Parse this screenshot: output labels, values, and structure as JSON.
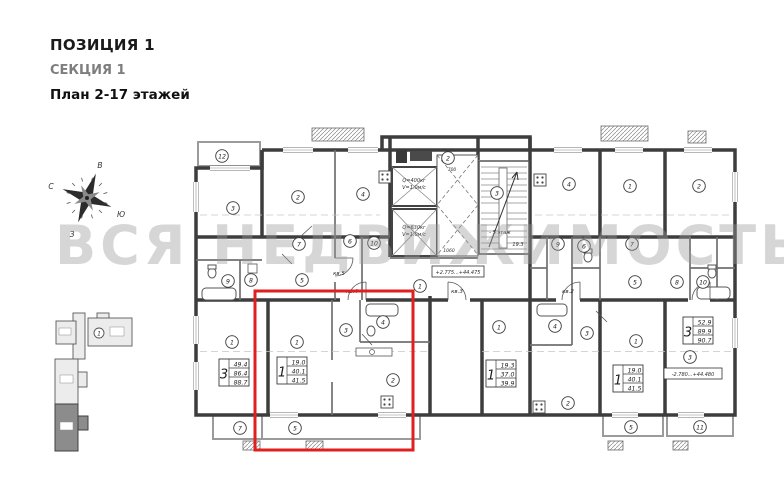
{
  "header": {
    "position": "ПОЗИЦИЯ 1",
    "section": "СЕКЦИЯ 1",
    "plan": "План 2-17 этажей"
  },
  "watermark": "ВСЯ НЕДВИЖИМОСТЬ",
  "compass": {
    "north": "С",
    "east": "В",
    "south": "Ю",
    "west": "З"
  },
  "minimap": {
    "position_label": "1"
  },
  "highlight": {
    "color": "#e01f1f"
  },
  "plan": {
    "elevators": [
      {
        "line1": "Q=400кг",
        "line2": "V=1.0м/с"
      },
      {
        "line1": "Q=630кг",
        "line2": "V=1.0м/с"
      }
    ],
    "stairs_note": "- 5 этаж",
    "stairs_area": "19.3",
    "dim_700": "700",
    "dim_1060": "1060",
    "elevation_core": "+2.775...+44.475",
    "elevation_right": "-2.780...+44.480",
    "apartment_labels": [
      {
        "label": "кв.5",
        "x": 339,
        "y": 275
      },
      {
        "label": "кв.4",
        "x": 352,
        "y": 293
      },
      {
        "label": "кв.3",
        "x": 457,
        "y": 293
      },
      {
        "label": "кв.2",
        "x": 568,
        "y": 293
      }
    ],
    "spec_tables": [
      {
        "rooms": "3",
        "values": [
          "49.4",
          "86.4",
          "88.7"
        ],
        "x": 219,
        "y": 359
      },
      {
        "rooms": "1",
        "values": [
          "19.0",
          "40.1",
          "41.5"
        ],
        "x": 277,
        "y": 357
      },
      {
        "rooms": "1",
        "values": [
          "19.3",
          "37.0",
          "39.9"
        ],
        "x": 486,
        "y": 360
      },
      {
        "rooms": "1",
        "values": [
          "19.0",
          "40.1",
          "41.5"
        ],
        "x": 613,
        "y": 365
      },
      {
        "rooms": "3",
        "values": [
          "52.9",
          "89.9",
          "90.7"
        ],
        "x": 683,
        "y": 317
      }
    ],
    "room_circles": [
      {
        "n": "12",
        "x": 222,
        "y": 156
      },
      {
        "n": "3",
        "x": 233,
        "y": 208
      },
      {
        "n": "2",
        "x": 298,
        "y": 197
      },
      {
        "n": "4",
        "x": 363,
        "y": 194
      },
      {
        "n": "2",
        "x": 448,
        "y": 158
      },
      {
        "n": "3",
        "x": 497,
        "y": 193
      },
      {
        "n": "4",
        "x": 569,
        "y": 184
      },
      {
        "n": "1",
        "x": 630,
        "y": 186
      },
      {
        "n": "2",
        "x": 699,
        "y": 186
      },
      {
        "n": "7",
        "x": 299,
        "y": 244
      },
      {
        "n": "6",
        "x": 350,
        "y": 241
      },
      {
        "n": "10",
        "x": 374,
        "y": 243
      },
      {
        "n": "9",
        "x": 558,
        "y": 244
      },
      {
        "n": "6",
        "x": 584,
        "y": 246
      },
      {
        "n": "7",
        "x": 632,
        "y": 244
      },
      {
        "n": "9",
        "x": 228,
        "y": 281
      },
      {
        "n": "8",
        "x": 251,
        "y": 280
      },
      {
        "n": "5",
        "x": 302,
        "y": 280
      },
      {
        "n": "1",
        "x": 420,
        "y": 286
      },
      {
        "n": "5",
        "x": 635,
        "y": 282
      },
      {
        "n": "8",
        "x": 677,
        "y": 282
      },
      {
        "n": "10",
        "x": 703,
        "y": 282
      },
      {
        "n": "1",
        "x": 232,
        "y": 342
      },
      {
        "n": "1",
        "x": 297,
        "y": 342
      },
      {
        "n": "3",
        "x": 346,
        "y": 330
      },
      {
        "n": "4",
        "x": 383,
        "y": 322
      },
      {
        "n": "2",
        "x": 393,
        "y": 380
      },
      {
        "n": "1",
        "x": 499,
        "y": 327
      },
      {
        "n": "4",
        "x": 555,
        "y": 326
      },
      {
        "n": "3",
        "x": 587,
        "y": 333
      },
      {
        "n": "2",
        "x": 568,
        "y": 403
      },
      {
        "n": "1",
        "x": 636,
        "y": 341
      },
      {
        "n": "3",
        "x": 690,
        "y": 357
      },
      {
        "n": "7",
        "x": 240,
        "y": 428
      },
      {
        "n": "5",
        "x": 295,
        "y": 428
      },
      {
        "n": "5",
        "x": 631,
        "y": 427
      },
      {
        "n": "11",
        "x": 700,
        "y": 427
      }
    ]
  }
}
